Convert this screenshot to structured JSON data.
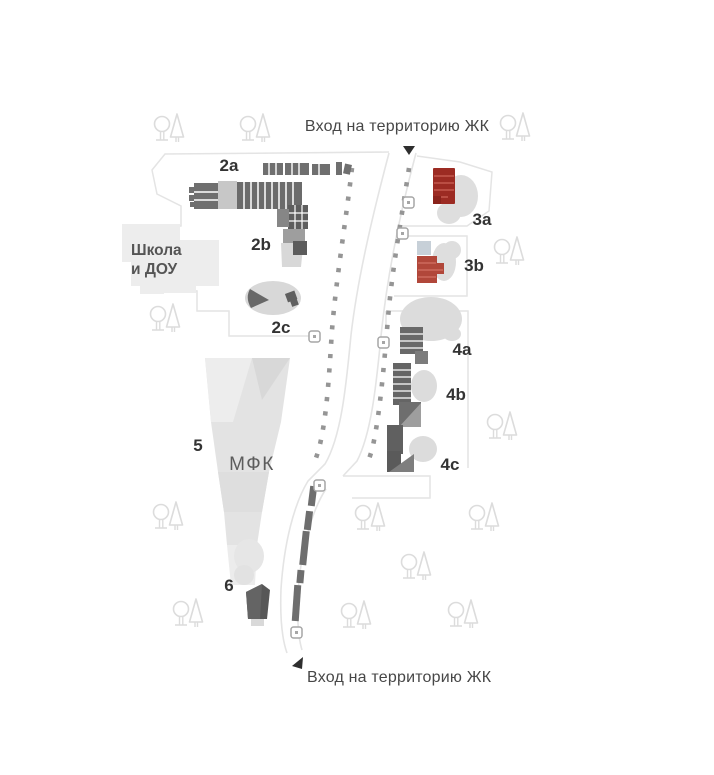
{
  "map": {
    "entrance_top_label": "Вход на территорию ЖК",
    "entrance_bottom_label": "Вход на территорию ЖК",
    "school_label": {
      "line1": "Школа",
      "line2": "и ДОУ"
    },
    "mfk_label": "МФК",
    "building_labels": {
      "b2a": "2a",
      "b2b": "2b",
      "b2c": "2c",
      "b3a": "3a",
      "b3b": "3b",
      "b4a": "4a",
      "b4b": "4b",
      "b4c": "4c",
      "b5": "5",
      "b6": "6"
    },
    "colors": {
      "accent_red": "#9c2b23",
      "accent_red_light": "#b1473a",
      "building_dark": "#676767",
      "building_mid": "#9a9a9a",
      "building_light": "#d9d9d9",
      "outline": "#e4e4e4",
      "dots": "#959595",
      "tree": "#dcdcdc",
      "text_primary": "#474747",
      "label_dark": "#333333"
    },
    "icons": {
      "tree": "tree-icon",
      "entrance_arrow_top": "arrow-down-icon",
      "entrance_arrow_bottom": "arrow-left-icon",
      "gate": "gate-marker-icon"
    }
  }
}
